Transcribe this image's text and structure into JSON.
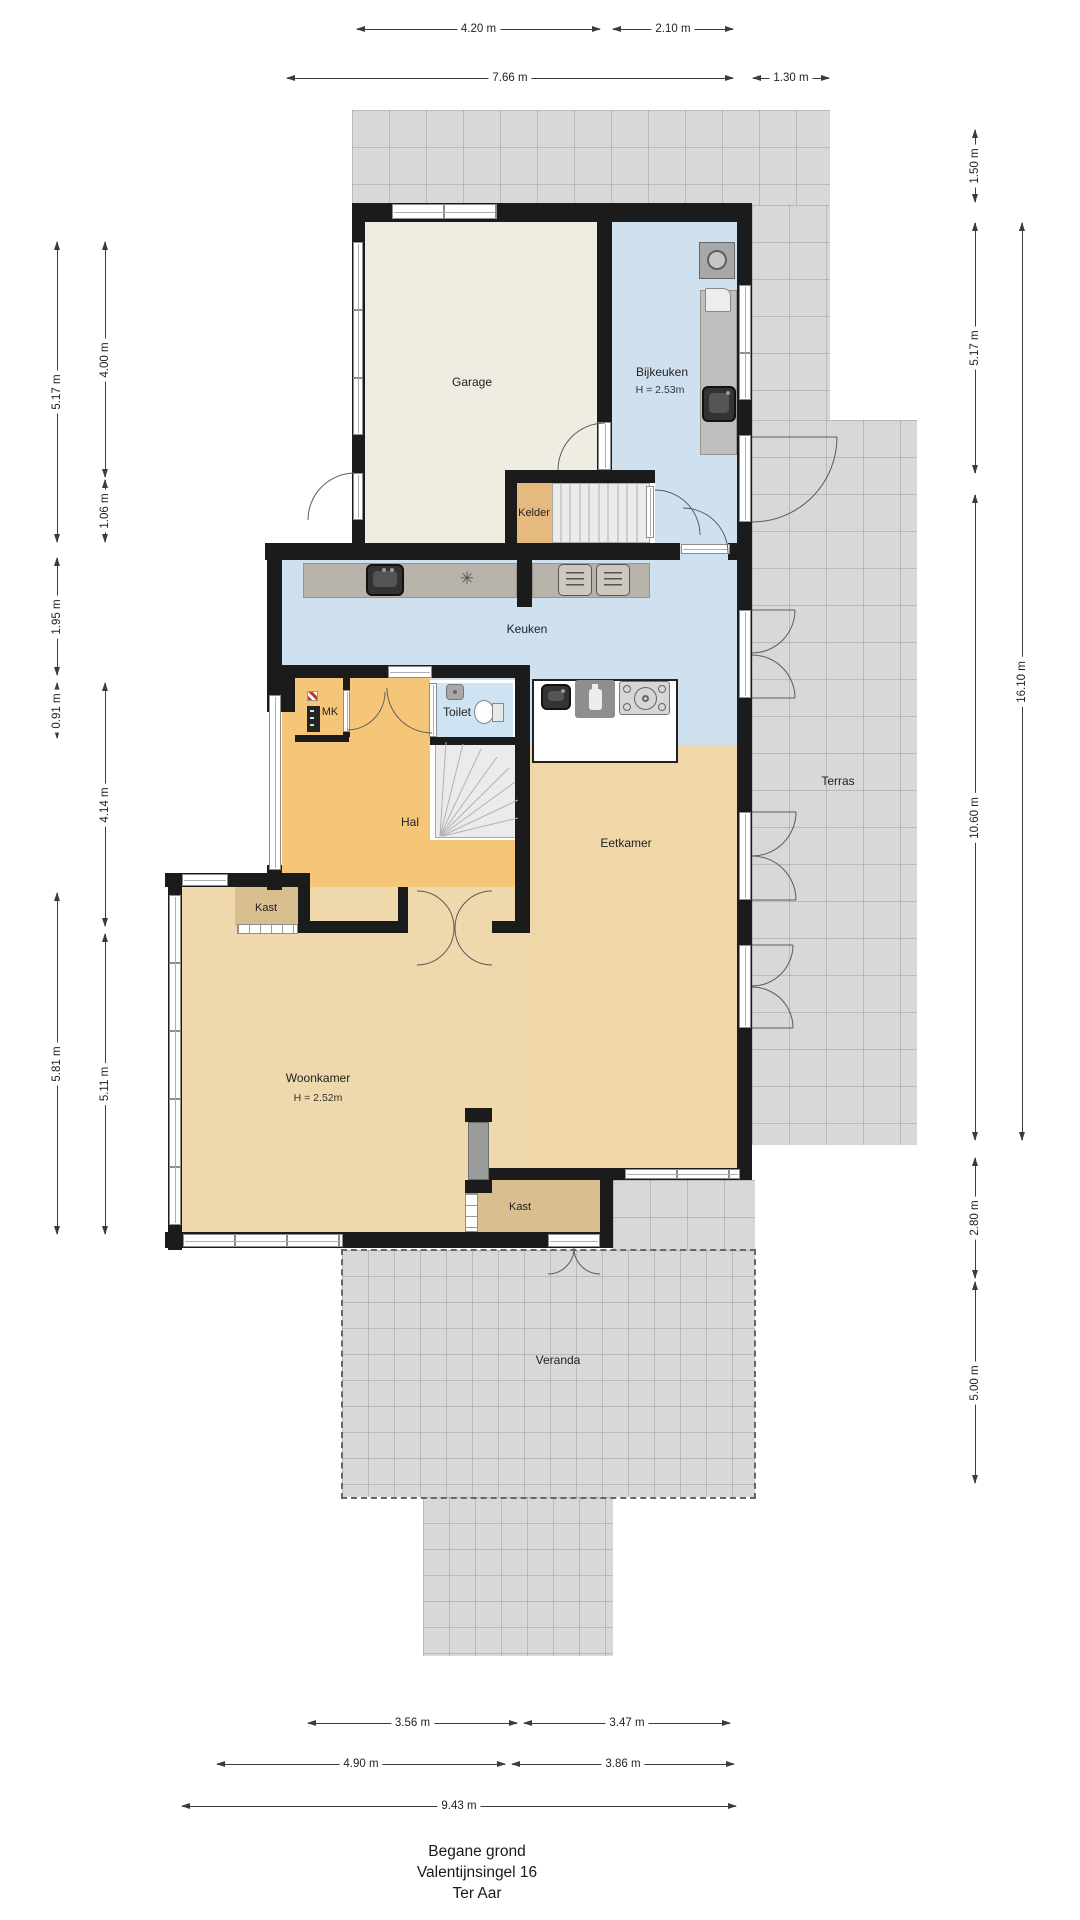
{
  "title": {
    "line1": "Begane grond",
    "line2": "Valentijnsingel 16",
    "line3": "Ter Aar"
  },
  "rooms": {
    "garage": {
      "label": "Garage"
    },
    "bijkeuken": {
      "label": "Bijkeuken",
      "height": "H = 2.53m"
    },
    "kelder": {
      "label": "Kelder"
    },
    "keuken": {
      "label": "Keuken"
    },
    "mk": {
      "label": "MK"
    },
    "toilet": {
      "label": "Toilet"
    },
    "hal": {
      "label": "Hal"
    },
    "eetkamer": {
      "label": "Eetkamer"
    },
    "terras": {
      "label": "Terras"
    },
    "kast_hal": {
      "label": "Kast"
    },
    "woonkamer": {
      "label": "Woonkamer",
      "height": "H = 2.52m"
    },
    "kast_woonkamer": {
      "label": "Kast"
    },
    "veranda": {
      "label": "Veranda"
    }
  },
  "dimensions": {
    "top": [
      "4.20 m",
      "2.10 m",
      "7.66 m",
      "1.30 m"
    ],
    "bottom": [
      "3.56 m",
      "3.47 m",
      "4.90 m",
      "3.86 m",
      "9.43 m"
    ],
    "left": [
      "5.17 m",
      "4.00 m",
      "1.06 m",
      "1.95 m",
      "0.91 m",
      "4.14 m",
      "5.81 m",
      "5.11 m"
    ],
    "right": [
      "1.50 m",
      "5.17 m",
      "16.10 m",
      "10.60 m",
      "2.80 m",
      "5.00 m"
    ]
  },
  "icons": {
    "freezer_symbol": "✳"
  },
  "colors": {
    "wall": "#1b1b1b",
    "tile": "#d8d8d8",
    "floor_garage": "#efede1",
    "floor_wet": "#cfe0ef",
    "floor_hal": "#f6c678",
    "floor_living": "#f0d7a8",
    "floor_kast": "#d9be90",
    "floor_kelder": "#e6ba7e",
    "counter": "#b8b3aa"
  }
}
